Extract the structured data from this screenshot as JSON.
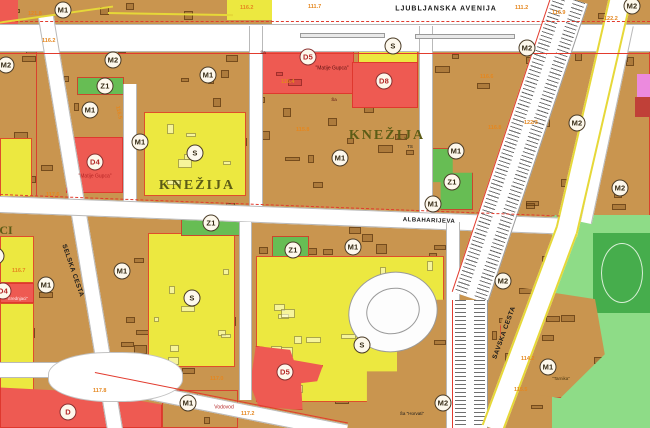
{
  "map": {
    "palette": {
      "tan": "#c9954f",
      "yellow": "#ece840",
      "red": "#ee5a52",
      "green": "#67bd54",
      "lgreen": "#8edc87",
      "dgreen": "#46ad4c",
      "pink": "#ec8ade",
      "dred": "#c04038",
      "kne": "#5c5c16",
      "black": "#1a1a1a",
      "dtext": "#b32424",
      "darkred": "#5a1010",
      "white": "#ffecec",
      "brown": "#4a3510",
      "orange": "#e5871f",
      "redline": "#e23b2e"
    },
    "zones": [
      {
        "n": "top-strip",
        "c": "tan",
        "x": 0,
        "y": 0,
        "w": 650,
        "h": 24,
        "tex": 1
      },
      {
        "n": "ne-block",
        "c": "tan",
        "x": 432,
        "y": 24,
        "w": 218,
        "h": 200,
        "tex": 1,
        "oc": 1
      },
      {
        "n": "se-block",
        "c": "tan",
        "x": 432,
        "y": 222,
        "w": 218,
        "h": 206,
        "tex": 1
      },
      {
        "n": "park",
        "c": "lgreen",
        "x": 552,
        "y": 215,
        "w": 98,
        "h": 213
      },
      {
        "n": "sports-field",
        "c": "dgreen",
        "x": 593,
        "y": 233,
        "w": 57,
        "h": 80,
        "oval": 1
      },
      {
        "n": "nw-left-edge",
        "c": "tan",
        "x": 0,
        "y": 26,
        "w": 60,
        "h": 176,
        "tex": 1
      },
      {
        "n": "left-yellow-a",
        "c": "yellow",
        "x": 0,
        "y": 138,
        "w": 32,
        "h": 68,
        "oc": 1
      },
      {
        "n": "knezija-west-block",
        "c": "tan",
        "x": 36,
        "y": 26,
        "w": 216,
        "h": 186,
        "tex": 1,
        "oc": 1
      },
      {
        "n": "knezija-east-block",
        "c": "tan",
        "x": 252,
        "y": 26,
        "w": 172,
        "h": 186,
        "tex": 1,
        "oc": 1
      },
      {
        "n": "school-d5-zone",
        "c": "red",
        "x": 254,
        "y": 28,
        "w": 100,
        "h": 66,
        "tex": 1,
        "oc": 1
      },
      {
        "n": "s-top-zone",
        "c": "yellow",
        "x": 358,
        "y": 30,
        "w": 60,
        "h": 62,
        "oc": 1
      },
      {
        "n": "d8-zone",
        "c": "red",
        "x": 352,
        "y": 62,
        "w": 66,
        "h": 46,
        "oc": 1
      },
      {
        "n": "z1-a",
        "c": "green",
        "x": 77,
        "y": 77,
        "w": 47,
        "h": 18,
        "oc": 1
      },
      {
        "n": "s-west-zone",
        "c": "yellow",
        "x": 144,
        "y": 112,
        "w": 102,
        "h": 84,
        "tex": 1,
        "oc": 1
      },
      {
        "n": "d4-matije-gupca-zone",
        "c": "red",
        "x": 66,
        "y": 137,
        "w": 57,
        "h": 56,
        "oc": 1
      },
      {
        "n": "z1-d",
        "c": "green",
        "x": 428,
        "y": 148,
        "w": 45,
        "h": 62,
        "oc": 1,
        "clip": "polygon(0 0,55% 0,55% 40%,100% 40%,100% 100%,28% 100%,28% 55%,0 55%)"
      },
      {
        "n": "sw-block",
        "c": "tan",
        "x": 0,
        "y": 196,
        "w": 252,
        "h": 232,
        "tex": 1
      },
      {
        "n": "left-yellow-b",
        "c": "yellow",
        "x": 0,
        "y": 236,
        "w": 34,
        "h": 47,
        "oc": 1
      },
      {
        "n": "d4-srednjaci-zone",
        "c": "red",
        "x": 0,
        "y": 283,
        "w": 34,
        "h": 20,
        "oc": 1
      },
      {
        "n": "left-yellow-c",
        "c": "yellow",
        "x": 0,
        "y": 303,
        "w": 34,
        "h": 88,
        "oc": 1
      },
      {
        "n": "s-sw-zone",
        "c": "yellow",
        "x": 148,
        "y": 233,
        "w": 87,
        "h": 134,
        "tex": 1,
        "oc": 1
      },
      {
        "n": "z1-b",
        "c": "green",
        "x": 181,
        "y": 214,
        "w": 62,
        "h": 22,
        "oc": 1
      },
      {
        "n": "d-vodovod-zone",
        "c": "red",
        "x": 0,
        "y": 383,
        "w": 162,
        "h": 45,
        "oc": 1,
        "clip": "polygon(0 10%,55% 20%,100% 48%,100% 100%,0 100%)"
      },
      {
        "n": "mid-south-block",
        "c": "tan",
        "x": 252,
        "y": 210,
        "w": 195,
        "h": 218,
        "tex": 1
      },
      {
        "n": "z1-c",
        "c": "green",
        "x": 272,
        "y": 236,
        "w": 37,
        "h": 53,
        "oc": 1
      },
      {
        "n": "s-mid-zone",
        "c": "yellow",
        "x": 256,
        "y": 256,
        "w": 188,
        "h": 146,
        "tex": 1,
        "oc": 1,
        "clip": "polygon(0 0,100% 0,100% 30%,87% 30%,87% 56%,75% 56%,75% 79%,59% 79%,59% 100%,0 100%)"
      },
      {
        "n": "d5-b-zone",
        "c": "red",
        "x": 250,
        "y": 346,
        "w": 73,
        "h": 64,
        "oc": 1,
        "clip": "polygon(8% 0,55% 6%,60% 22%,100% 30%,92% 55%,70% 58%,72% 100%,12% 95%,0 60%)"
      },
      {
        "n": "vodovod-island",
        "c": "tan",
        "x": 162,
        "y": 390,
        "w": 76,
        "h": 38,
        "tex": 1,
        "oc": 1
      },
      {
        "n": "m1-island",
        "c": "tan",
        "x": 500,
        "y": 283,
        "w": 108,
        "h": 115,
        "tex": 1,
        "oc": 1,
        "clip": "polygon(12% 3%,88% 14%,97% 62%,56% 100%,4% 93%,0 38%)"
      },
      {
        "n": "pink-zone",
        "c": "pink",
        "x": 637,
        "y": 74,
        "w": 13,
        "h": 23
      },
      {
        "n": "dred-zone",
        "c": "dred",
        "x": 635,
        "y": 97,
        "w": 15,
        "h": 20
      },
      {
        "n": "top-red-corner",
        "c": "red",
        "x": 0,
        "y": 0,
        "w": 18,
        "h": 24
      },
      {
        "n": "top-yellow-strip",
        "c": "yellow",
        "x": 227,
        "y": 0,
        "w": 132,
        "h": 20
      }
    ],
    "roads": [
      {
        "n": "ljubljanska-top-patch",
        "x": 272,
        "y": 0,
        "w": 290,
        "h": 28,
        "r": 0,
        "s": "patch"
      },
      {
        "n": "ljubljanska-avenija-road",
        "x": 0,
        "y": 24,
        "w": 650,
        "h": 28,
        "r": 0,
        "s": "h"
      },
      {
        "n": "selska-cesta-road",
        "x": 38,
        "y": 18,
        "w": 16,
        "h": 436,
        "r": -9.5,
        "s": "v"
      },
      {
        "n": "street-1",
        "x": 123,
        "y": 84,
        "w": 14,
        "h": 130,
        "r": 0,
        "s": "v"
      },
      {
        "n": "street-2",
        "x": 249,
        "y": 26,
        "w": 14,
        "h": 188,
        "r": 0,
        "s": "v"
      },
      {
        "n": "street-3",
        "x": 419,
        "y": 26,
        "w": 14,
        "h": 190,
        "r": 0,
        "s": "v"
      },
      {
        "n": "albaharijeva-road",
        "x": 0,
        "y": 196,
        "w": 562,
        "h": 17,
        "r": 2.2,
        "s": "h"
      },
      {
        "n": "street-4",
        "x": 239,
        "y": 222,
        "w": 13,
        "h": 178,
        "r": 0,
        "s": "v"
      },
      {
        "n": "street-5",
        "x": 446,
        "y": 222,
        "w": 14,
        "h": 206,
        "r": 0,
        "s": "v"
      },
      {
        "n": "diagonal-road",
        "x": 95,
        "y": 374,
        "w": 258,
        "h": 15,
        "r": 11.3,
        "s": "h"
      },
      {
        "n": "west-road",
        "x": 0,
        "y": 362,
        "w": 60,
        "h": 16,
        "r": 0,
        "s": "h"
      },
      {
        "n": "intersection",
        "x": 48,
        "y": 352,
        "w": 135,
        "h": 50,
        "r": 0,
        "s": "blob"
      },
      {
        "n": "east-street",
        "x": 622,
        "y": 24,
        "w": 12,
        "h": 202,
        "r": 12,
        "s": "v"
      },
      {
        "n": "median-1",
        "x": 300,
        "y": 33,
        "w": 85,
        "h": 5,
        "r": 0,
        "s": "island"
      },
      {
        "n": "median-2",
        "x": 415,
        "y": 34,
        "w": 100,
        "h": 5,
        "r": 0,
        "s": "island"
      }
    ],
    "railway": [
      {
        "n": "railway-segment-1",
        "x": 552,
        "y": -8,
        "w": 38,
        "h": 316,
        "r": 18.5
      },
      {
        "n": "railway-segment-2",
        "x": 452,
        "y": 300,
        "w": 36,
        "h": 128,
        "r": 0
      }
    ],
    "savska": [
      {
        "n": "savska-cesta-road-1",
        "x": 610,
        "y": -8,
        "w": 23,
        "h": 246,
        "r": 13
      },
      {
        "n": "savska-cesta-road-2",
        "x": 556,
        "y": 226,
        "w": 23,
        "h": 212,
        "r": 20.5
      }
    ],
    "loop": {
      "outer": {
        "x": 348,
        "y": 272,
        "w": 88,
        "h": 78
      },
      "inner": {
        "x": 366,
        "y": 288,
        "w": 52,
        "h": 44
      }
    },
    "red_lines": [
      {
        "x": 0,
        "y": 21,
        "w": 650,
        "r": 0,
        "dash": 1
      },
      {
        "x": 0,
        "y": 53,
        "w": 650,
        "r": 0
      },
      {
        "x": 0,
        "y": 194,
        "w": 560,
        "r": 2.2,
        "dash": 1
      },
      {
        "x": 95,
        "y": 372,
        "w": 258,
        "r": 11.3
      }
    ],
    "yellow_lines": [
      {
        "x": -4,
        "y": 22,
        "w": 118,
        "r": -8
      },
      {
        "x": 108,
        "y": 12,
        "w": 125,
        "r": 1
      }
    ],
    "circles": [
      {
        "t": "M1",
        "x": 63,
        "y": 10
      },
      {
        "t": "M2",
        "x": 6,
        "y": 65
      },
      {
        "t": "M2",
        "x": 113,
        "y": 60
      },
      {
        "t": "Z1",
        "x": 105,
        "y": 86
      },
      {
        "t": "M1",
        "x": 90,
        "y": 110
      },
      {
        "t": "M1",
        "x": 208,
        "y": 75
      },
      {
        "t": "M1",
        "x": 140,
        "y": 142
      },
      {
        "t": "S",
        "x": 195,
        "y": 153
      },
      {
        "t": "D4",
        "x": 95,
        "y": 162,
        "d": 1
      },
      {
        "t": "D5",
        "x": 308,
        "y": 57,
        "d": 1
      },
      {
        "t": "S",
        "x": 393,
        "y": 46
      },
      {
        "t": "D8",
        "x": 384,
        "y": 81,
        "d": 1
      },
      {
        "t": "M1",
        "x": 340,
        "y": 158
      },
      {
        "t": "M2",
        "x": 527,
        "y": 48
      },
      {
        "t": "M2",
        "x": 577,
        "y": 123
      },
      {
        "t": "M1",
        "x": 456,
        "y": 151
      },
      {
        "t": "Z1",
        "x": 452,
        "y": 182
      },
      {
        "t": "M1",
        "x": 433,
        "y": 204
      },
      {
        "t": "M2",
        "x": 632,
        "y": 6
      },
      {
        "t": "M2",
        "x": 620,
        "y": 188
      },
      {
        "t": "M1",
        "x": 46,
        "y": 285
      },
      {
        "t": "M1",
        "x": 122,
        "y": 271
      },
      {
        "t": "S",
        "x": 192,
        "y": 298
      },
      {
        "t": "Z1",
        "x": 211,
        "y": 223
      },
      {
        "t": "Z1",
        "x": 293,
        "y": 250
      },
      {
        "t": "M1",
        "x": 353,
        "y": 247
      },
      {
        "t": "M1",
        "x": 188,
        "y": 403
      },
      {
        "t": "D",
        "x": 68,
        "y": 412,
        "d": 1
      },
      {
        "t": "D5",
        "x": 285,
        "y": 372,
        "d": 1
      },
      {
        "t": "S",
        "x": 362,
        "y": 345
      },
      {
        "t": "M2",
        "x": 443,
        "y": 403
      },
      {
        "t": "M2",
        "x": 503,
        "y": 281
      },
      {
        "t": "M1",
        "x": 548,
        "y": 367
      },
      {
        "t": "D4",
        "x": 3,
        "y": 291,
        "d": 1
      },
      {
        "t": "S",
        "x": -4,
        "y": 256
      }
    ],
    "texts": [
      {
        "n": "street-label-ljubljanska-avenija",
        "t": "LJUBLJANSKA AVENIJA",
        "x": 446,
        "y": 9,
        "s": 7,
        "c": "black",
        "b": 1,
        "ls": 1
      },
      {
        "n": "district-label-knezija-west",
        "t": "KNEŽIJA",
        "x": 197,
        "y": 186,
        "s": 14,
        "c": "kne",
        "b": 1,
        "f": 1,
        "ls": 2
      },
      {
        "n": "district-label-knezija-east",
        "t": "KNEŽIJA",
        "x": 387,
        "y": 136,
        "s": 14,
        "c": "kne",
        "b": 1,
        "f": 1,
        "ls": 2
      },
      {
        "n": "street-label-selska-cesta",
        "t": "SELSKA CESTA",
        "x": 72,
        "y": 271,
        "s": 6.5,
        "c": "black",
        "b": 1,
        "r": 71,
        "ls": 0.5
      },
      {
        "n": "street-label-savska-cesta",
        "t": "SAVSKA CESTA",
        "x": 505,
        "y": 333,
        "s": 6.5,
        "c": "black",
        "b": 1,
        "r": -70,
        "ls": 0.5
      },
      {
        "n": "street-label-albaharijeva",
        "t": "ALBAHARIJEVA",
        "x": 429,
        "y": 221,
        "s": 6,
        "c": "black",
        "b": 1,
        "r": 2,
        "ls": 0.5
      },
      {
        "n": "school-label-matije-gupca-1",
        "t": "\"Matije Gupca\"",
        "x": 95,
        "y": 177,
        "s": 5,
        "c": "dtext"
      },
      {
        "n": "school-label-matije-gupca-2",
        "t": "\"Matije Gupca\"",
        "x": 332,
        "y": 69,
        "s": 5,
        "c": "darkred"
      },
      {
        "n": "school-label-srednjaci",
        "t": "\"Srednjaci\"",
        "x": 17,
        "y": 299,
        "s": 4.5,
        "c": "white"
      },
      {
        "n": "facility-label-vodovod",
        "t": "Vodovod",
        "x": 224,
        "y": 408,
        "s": 5,
        "c": "dtext"
      },
      {
        "n": "facility-label-tarnika",
        "t": "\"Tarnika\"",
        "x": 561,
        "y": 379,
        "s": 4.5,
        "c": "brown"
      },
      {
        "n": "school-mark-horvati",
        "t": "Ša \"Horvati\"",
        "x": 412,
        "y": 414,
        "s": 4.5,
        "c": "black"
      },
      {
        "n": "substation-label-ts",
        "t": "TS",
        "x": 410,
        "y": 147,
        "s": 4.5,
        "c": "black"
      },
      {
        "n": "district-label-srednjaci-partial",
        "t": "CI",
        "x": 6,
        "y": 230,
        "s": 12,
        "c": "kne",
        "b": 1,
        "f": 1
      },
      {
        "n": "school-mark-1",
        "t": "Ša",
        "x": 263,
        "y": 53,
        "s": 4.5,
        "c": "darkred"
      },
      {
        "n": "school-mark-2",
        "t": "Ša",
        "x": 334,
        "y": 100,
        "s": 4.5,
        "c": "darkred"
      }
    ],
    "elevations": [
      {
        "t": "121.8",
        "x": 28,
        "y": 12
      },
      {
        "t": "116.2",
        "x": 42,
        "y": 39
      },
      {
        "t": "116.2",
        "x": 240,
        "y": 6
      },
      {
        "t": "111.7",
        "x": 308,
        "y": 5
      },
      {
        "t": "111.2",
        "x": 515,
        "y": 6
      },
      {
        "t": "116.9",
        "x": 552,
        "y": 11
      },
      {
        "t": "122.2",
        "x": 604,
        "y": 17
      },
      {
        "t": "116.4",
        "x": 281,
        "y": 80
      },
      {
        "t": "116.5",
        "x": 111,
        "y": 110,
        "r": 78
      },
      {
        "t": "115.8",
        "x": 296,
        "y": 128
      },
      {
        "t": "116.8",
        "x": 488,
        "y": 126
      },
      {
        "t": "122/3",
        "x": 524,
        "y": 121
      },
      {
        "t": "116.6",
        "x": 480,
        "y": 75
      },
      {
        "t": "117.6",
        "x": 46,
        "y": 193
      },
      {
        "t": "116.7",
        "x": 12,
        "y": 269
      },
      {
        "t": "117.8",
        "x": 93,
        "y": 389
      },
      {
        "t": "117.0",
        "x": 210,
        "y": 377
      },
      {
        "t": "117.2",
        "x": 241,
        "y": 412
      },
      {
        "t": "114.2",
        "x": 521,
        "y": 357
      },
      {
        "t": "115.5",
        "x": 514,
        "y": 388
      }
    ]
  }
}
